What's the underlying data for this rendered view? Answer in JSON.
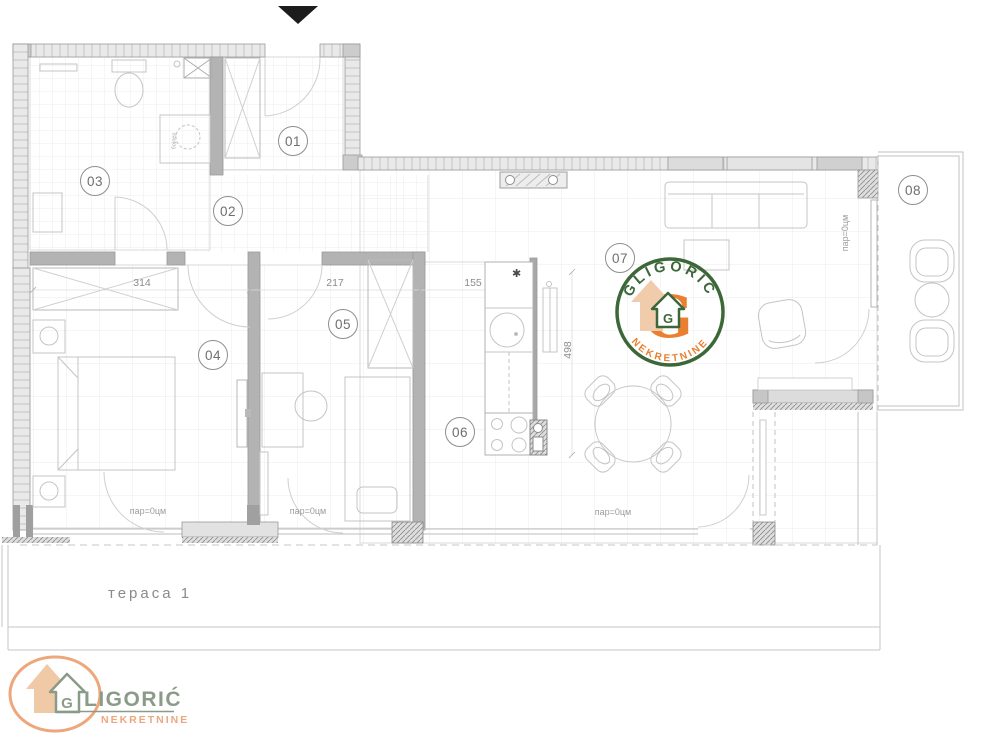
{
  "plan": {
    "terrace_label": "тераса  1",
    "kitchen_star": "✱",
    "boiler_label": "бојлер",
    "rooms": [
      {
        "id": "01",
        "x": 293,
        "y": 141
      },
      {
        "id": "02",
        "x": 228,
        "y": 211
      },
      {
        "id": "03",
        "x": 95,
        "y": 181
      },
      {
        "id": "04",
        "x": 213,
        "y": 355
      },
      {
        "id": "05",
        "x": 343,
        "y": 324
      },
      {
        "id": "06",
        "x": 460,
        "y": 432
      },
      {
        "id": "07",
        "x": 620,
        "y": 258
      },
      {
        "id": "08",
        "x": 913,
        "y": 190
      }
    ],
    "dimensions": [
      {
        "label": "314",
        "x": 142,
        "y": 283,
        "rot": 0
      },
      {
        "label": "217",
        "x": 335,
        "y": 283,
        "rot": 0
      },
      {
        "label": "155",
        "x": 473,
        "y": 283,
        "rot": 0
      },
      {
        "label": "498",
        "x": 568,
        "y": 350,
        "rot": -90
      }
    ],
    "floor_labels": [
      {
        "text": "пар=0цм",
        "x": 148,
        "y": 511,
        "rot": 0
      },
      {
        "text": "пар=0цм",
        "x": 308,
        "y": 511,
        "rot": 0
      },
      {
        "text": "пар=0цм",
        "x": 613,
        "y": 512,
        "rot": 0
      },
      {
        "text": "пар=0цм",
        "x": 845,
        "y": 233,
        "rot": -90
      }
    ]
  },
  "watermark": {
    "brand": "GLIGORIĆ",
    "subtitle": "NEKRETNINE",
    "letter": "G",
    "house_letter": "G"
  },
  "footer_logo": {
    "brand": "GLIGORIĆ",
    "brand_rest": "LIGORIĆ",
    "subtitle": "NEKRETNINE",
    "house_letter": "G"
  },
  "colors": {
    "wm_green": "#2e5d2b",
    "wm_orange": "#e87722",
    "logo_peach": "#eda77b",
    "logo_sage": "#8a9b88",
    "house_tan": "#f0c9a6",
    "ink": "#1c1c1c"
  }
}
